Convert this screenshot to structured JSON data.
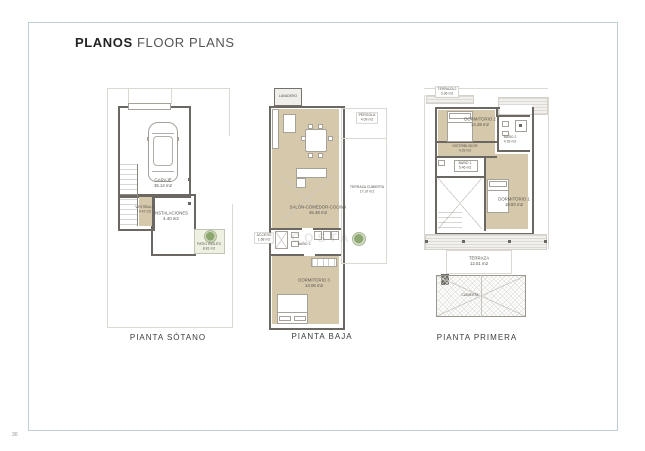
{
  "page": {
    "number": "30"
  },
  "header": {
    "title_bold": "PLANOS",
    "title_regular": "FLOOR PLANS"
  },
  "watermark": {
    "text": "COSTA"
  },
  "colors": {
    "frame": "#bccfd4",
    "wall": "#6b6762",
    "floor_tan": "#d6c8ab",
    "patio_green": "#eef1e2",
    "plant_green": "#7a995a",
    "label_text": "#57544e"
  },
  "plans": [
    {
      "caption": "PIANTA SÓTANO",
      "rooms": {
        "garaje": {
          "name": "GARAJE",
          "area": "35.14 m2"
        },
        "vestibulo": {
          "name": "VESTÍBULO",
          "area": "4.47 m2"
        },
        "instalaciones": {
          "name": "INSTALACIONES",
          "area": "4.40 m2"
        },
        "patio": {
          "name": "PATIO INGLÉS",
          "area": "8.81 m2"
        }
      }
    },
    {
      "caption": "PIANTA BAJA",
      "rooms": {
        "lavadero": {
          "name": "LAVADERO",
          "area": ""
        },
        "pergola": {
          "name": "PÉRGOLA",
          "area": "4.09 m2"
        },
        "terraza_cubierta": {
          "name": "TERRAZA CUBIERTA",
          "area": "17.37 m2"
        },
        "salon": {
          "name": "SALÓN-COMEDOR-COCINA",
          "area": "45.48 m2"
        },
        "acceso": {
          "name": "ACCESO",
          "area": "1.68 m2"
        },
        "bano3": {
          "name": "BAÑO 3",
          "area": ""
        },
        "dormitorio3": {
          "name": "DORMITORIO 3",
          "area": "13.06 m2"
        }
      }
    },
    {
      "caption": "PIANTA PRIMERA",
      "rooms": {
        "terraza2": {
          "name": "TERRAZA 2",
          "area": "3.36 m2"
        },
        "dormitorio2": {
          "name": "DORMITORIO 2",
          "area": "14.28 m2"
        },
        "bano2": {
          "name": "BAÑO 2",
          "area": "4.33 m2"
        },
        "distribuidor": {
          "name": "DISTRIBUIDOR",
          "area": "4.29 m2"
        },
        "bano1": {
          "name": "BAÑO 1",
          "area": "5.46 m2"
        },
        "dormitorio1": {
          "name": "DORMITORIO 1",
          "area": "18.83 m2"
        },
        "terraza": {
          "name": "TERRAZA",
          "area": "12.51 m2"
        },
        "cubierta": {
          "name": "CUBIERTA",
          "area": ""
        }
      }
    }
  ]
}
